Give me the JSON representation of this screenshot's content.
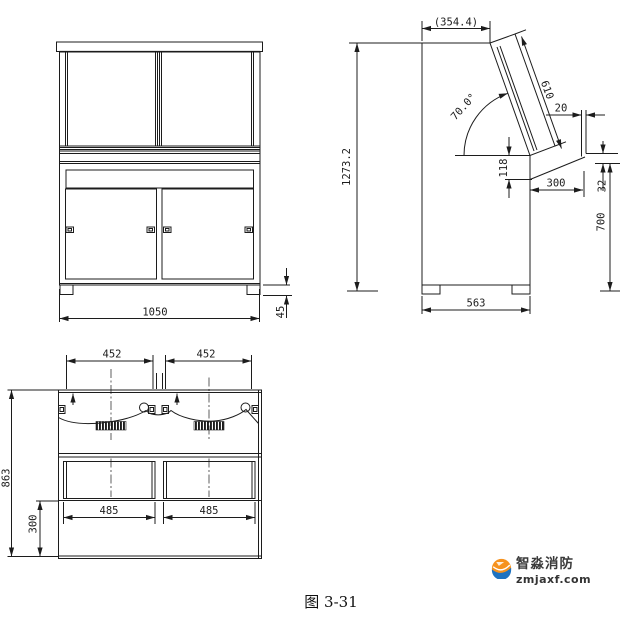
{
  "colors": {
    "line": "#1c1c1c",
    "logo_orange": "#f6921e",
    "logo_blue": "#1e72c0",
    "logo_text": "#3a3a3a"
  },
  "logo": {
    "name": "智淼消防",
    "domain": "zmjaxf.com"
  },
  "caption": "图 3-31",
  "views": {
    "front": {
      "dims": {
        "width": "1050",
        "foot_height": "45"
      }
    },
    "side": {
      "dims": {
        "top_depth": "(354.4)",
        "total_height": "1273.2",
        "panel_length": "610",
        "panel_angle": "70.0°",
        "lip_thickness": "20",
        "desk_drop": "118",
        "desk_depth": "300",
        "front_edge_drop": "32",
        "desk_height": "700",
        "base_depth": "563"
      }
    },
    "rear": {
      "dims": {
        "left_door_width": "452",
        "right_door_width": "452",
        "total_height": "863",
        "plinth_height": "300",
        "left_bay_width": "485",
        "right_bay_width": "485"
      }
    }
  }
}
